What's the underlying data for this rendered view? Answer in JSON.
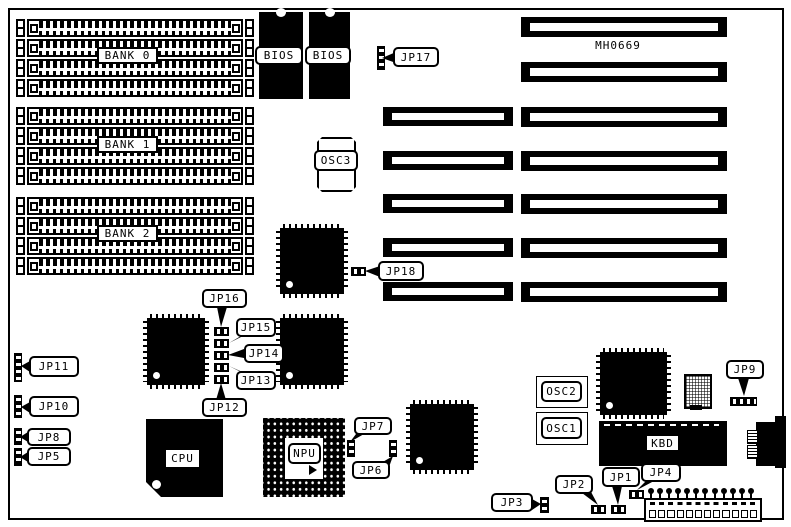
{
  "board": {
    "model": "MH0669",
    "ink_color": "#000000",
    "paper_color": "#ffffff"
  },
  "memory": {
    "sockets_per_bank": 4,
    "banks": [
      {
        "label": "BANK 0"
      },
      {
        "label": "BANK 1"
      },
      {
        "label": "BANK 2"
      }
    ]
  },
  "chips": {
    "bios_left": {
      "label": "BIOS"
    },
    "bios_right": {
      "label": "BIOS"
    },
    "cpu": {
      "label": "CPU"
    },
    "npu": {
      "label": "NPU"
    },
    "keyboard_controller": {
      "label": "KBD"
    }
  },
  "oscillators": {
    "osc1": {
      "label": "OSC1"
    },
    "osc2": {
      "label": "OSC2"
    },
    "osc3": {
      "label": "OSC3"
    }
  },
  "jumpers": {
    "jp1": {
      "label": "JP1"
    },
    "jp2": {
      "label": "JP2"
    },
    "jp3": {
      "label": "JP3"
    },
    "jp4": {
      "label": "JP4"
    },
    "jp5": {
      "label": "JP5"
    },
    "jp6": {
      "label": "JP6"
    },
    "jp7": {
      "label": "JP7"
    },
    "jp8": {
      "label": "JP8"
    },
    "jp9": {
      "label": "JP9"
    },
    "jp10": {
      "label": "JP10"
    },
    "jp11": {
      "label": "JP11"
    },
    "jp12": {
      "label": "JP12"
    },
    "jp13": {
      "label": "JP13"
    },
    "jp14": {
      "label": "JP14"
    },
    "jp15": {
      "label": "JP15"
    },
    "jp16": {
      "label": "JP16"
    },
    "jp17": {
      "label": "JP17"
    },
    "jp18": {
      "label": "JP18"
    }
  },
  "expansion_slots": {
    "long_slots": 7,
    "short_extensions": 5
  }
}
